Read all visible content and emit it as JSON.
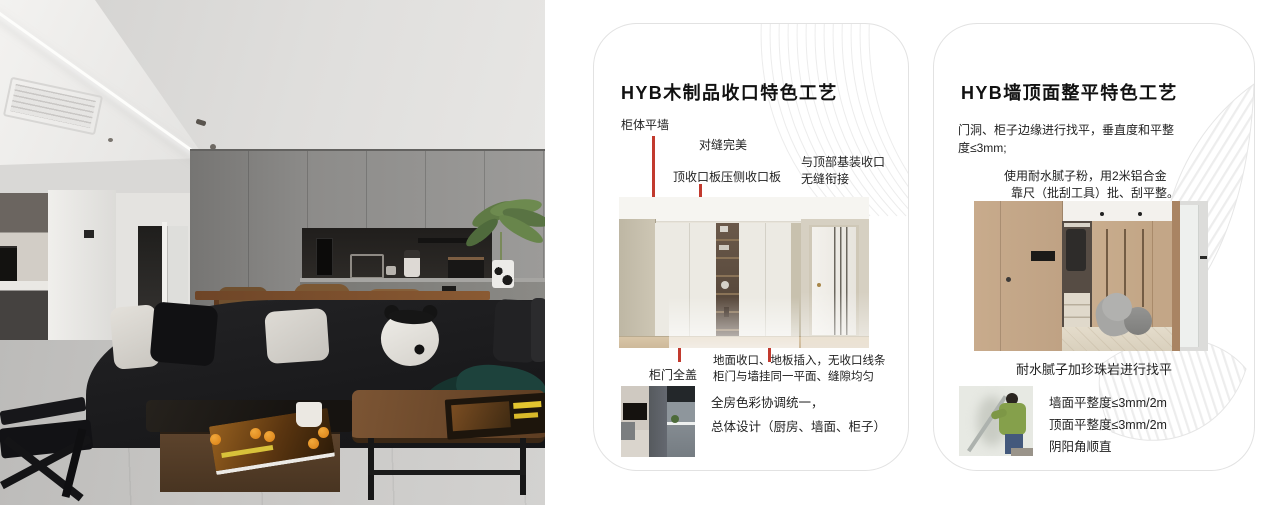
{
  "accent_color": "#c23a2e",
  "cards": [
    {
      "title": "HYB木制品收口特色工艺",
      "callout_cabinet_flush_wall": "柜体平墙",
      "callout_perfect_seam": "对缝完美",
      "callout_top_closing_board": "顶收口板压侧收口板",
      "callout_ceiling_joint_line1": "与顶部基装收口",
      "callout_ceiling_joint_line2": "无缝衔接",
      "callout_full_cover_door": "柜门全盖",
      "callout_floor_joint_line1": "地面收口、地板插入，无收口线条",
      "callout_floor_joint_line2": "柜门与墙挂同一平面、缝隙均匀",
      "summary_line1": "全房色彩协调统一，",
      "summary_line2": "总体设计（厨房、墙面、柜子）"
    },
    {
      "title": "HYB墙顶面整平特色工艺",
      "para1_line1": "门洞、柜子边缘进行找平，垂直度和平整",
      "para1_line2": "度≤3mm;",
      "para2_line1": "使用耐水腻子粉，用2米铝合金",
      "para2_line2": "靠尺（批刮工具）批、刮平整。",
      "image_caption": "耐水腻子加珍珠岩进行找平",
      "spec_line1": "墙面平整度≤3mm/2m",
      "spec_line2": "顶面平整度≤3mm/2m",
      "spec_line3": "阴阳角顺直"
    }
  ]
}
